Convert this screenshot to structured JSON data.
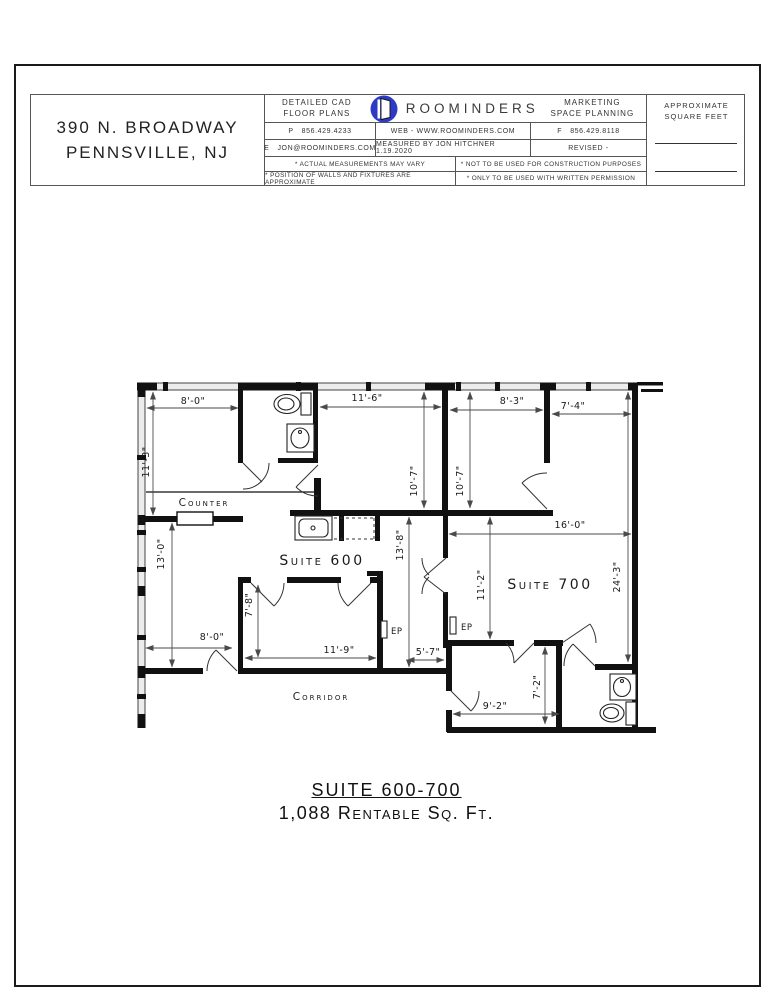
{
  "title_block": {
    "address_line1": "390 N. BROADWAY",
    "address_line2": "PENNSVILLE, NJ",
    "services_left_line1": "DETAILED CAD",
    "services_left_line2": "FLOOR PLANS",
    "brand": "ROOMINDERS",
    "logo_icon": "open-door-logo",
    "logo_color": "#2d3bc4",
    "services_right_line1": "MARKETING",
    "services_right_line2": "SPACE PLANNING",
    "approx_line1": "APPROXIMATE",
    "approx_line2": "SQUARE FEET",
    "phone_label": "P",
    "phone": "856.429.4233",
    "web": "WEB - WWW.ROOMINDERS.COM",
    "fax_label": "F",
    "fax": "856.429.8118",
    "email_label": "E",
    "email": "JON@ROOMINDERS.COM",
    "measured_by": "MEASURED BY JON HITCHNER 1.19.2020",
    "revised": "REVISED -",
    "note1": "* ACTUAL MEASUREMENTS MAY VARY",
    "note2": "* NOT TO BE USED FOR CONSTRUCTION PURPOSES",
    "note3": "* POSITION OF WALLS AND FIXTURES ARE APPROXIMATE",
    "note4": "* ONLY TO BE USED WITH WRITTEN PERMISSION"
  },
  "plan": {
    "labels": {
      "counter": "Counter",
      "suite600": "Suite 600",
      "suite700": "Suite 700",
      "corridor": "Corridor",
      "ep": "EP"
    },
    "dimensions": {
      "top_left_room_width": "8'-0\"",
      "top_left_room_depth": "11'-3\"",
      "top_mid_room_width": "11'-6\"",
      "top_mid_room_depth": "10'-7\"",
      "top_right_room_width": "8'-3\"",
      "top_right_room_depth": "10'-7\"",
      "far_right_room_width": "7'-4\"",
      "suite700_width": "16'-0\"",
      "suite700_depth": "24'-3\"",
      "suite700_left_depth": "11'-2\"",
      "suite600_hall_depth": "13'-8\"",
      "reception_depth": "13'-0\"",
      "mid_room_depth": "7'-8\"",
      "mid_room_width": "11'-9\"",
      "reception_width": "8'-0\"",
      "hall_width": "5'-7\"",
      "rear_room_depth": "7'-2\"",
      "rear_room_width": "9'-2\""
    },
    "fixture_icons": [
      "toilet-icon",
      "sink-icon",
      "kitchen-sink-icon",
      "toilet-icon",
      "sink-icon"
    ]
  },
  "footer": {
    "suite_title": "SUITE 600-700",
    "area_text": "1,088 Rentable Sq. Ft."
  }
}
